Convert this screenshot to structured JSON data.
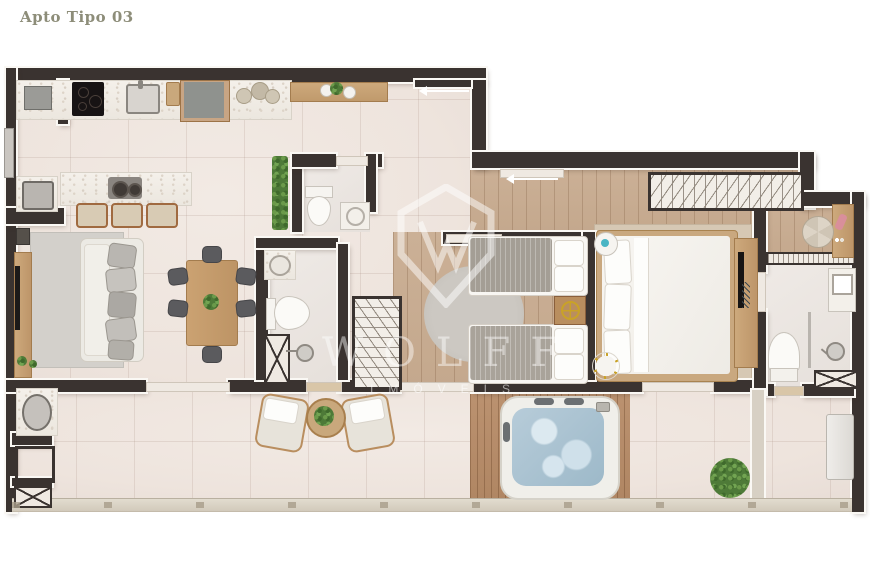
{
  "header": {
    "title": "Apto Tipo 03"
  },
  "watermark": {
    "brand": "WOLFF",
    "tagline": "IMÓVEIS"
  },
  "colors": {
    "wall": "#3a3330",
    "tile_floor": "#efe6e0",
    "wood_floor": "#c8ad93",
    "deck_wood": "#b8906c",
    "greenery": "#4e7a38",
    "hot_tub_water": "#aec7d8",
    "title_text": "#8d8d79",
    "watermark": "rgba(255,255,255,0.45)"
  },
  "furniture_shown": [
    "kitchen counter with cooktop and sink",
    "refrigerator",
    "kitchen island with stools",
    "sofa",
    "tv rack",
    "dining table with chairs",
    "powder room toilet and sink",
    "vertical garden",
    "social bathroom",
    "hall closet",
    "twin beds with nightstand",
    "master bed",
    "wardrobe",
    "vanity and pouf",
    "ensuite bathroom",
    "barbecue corner",
    "terrace armchairs and side table",
    "hot tub on deck",
    "terrace plant",
    "terrace bench",
    "balcony railing"
  ]
}
